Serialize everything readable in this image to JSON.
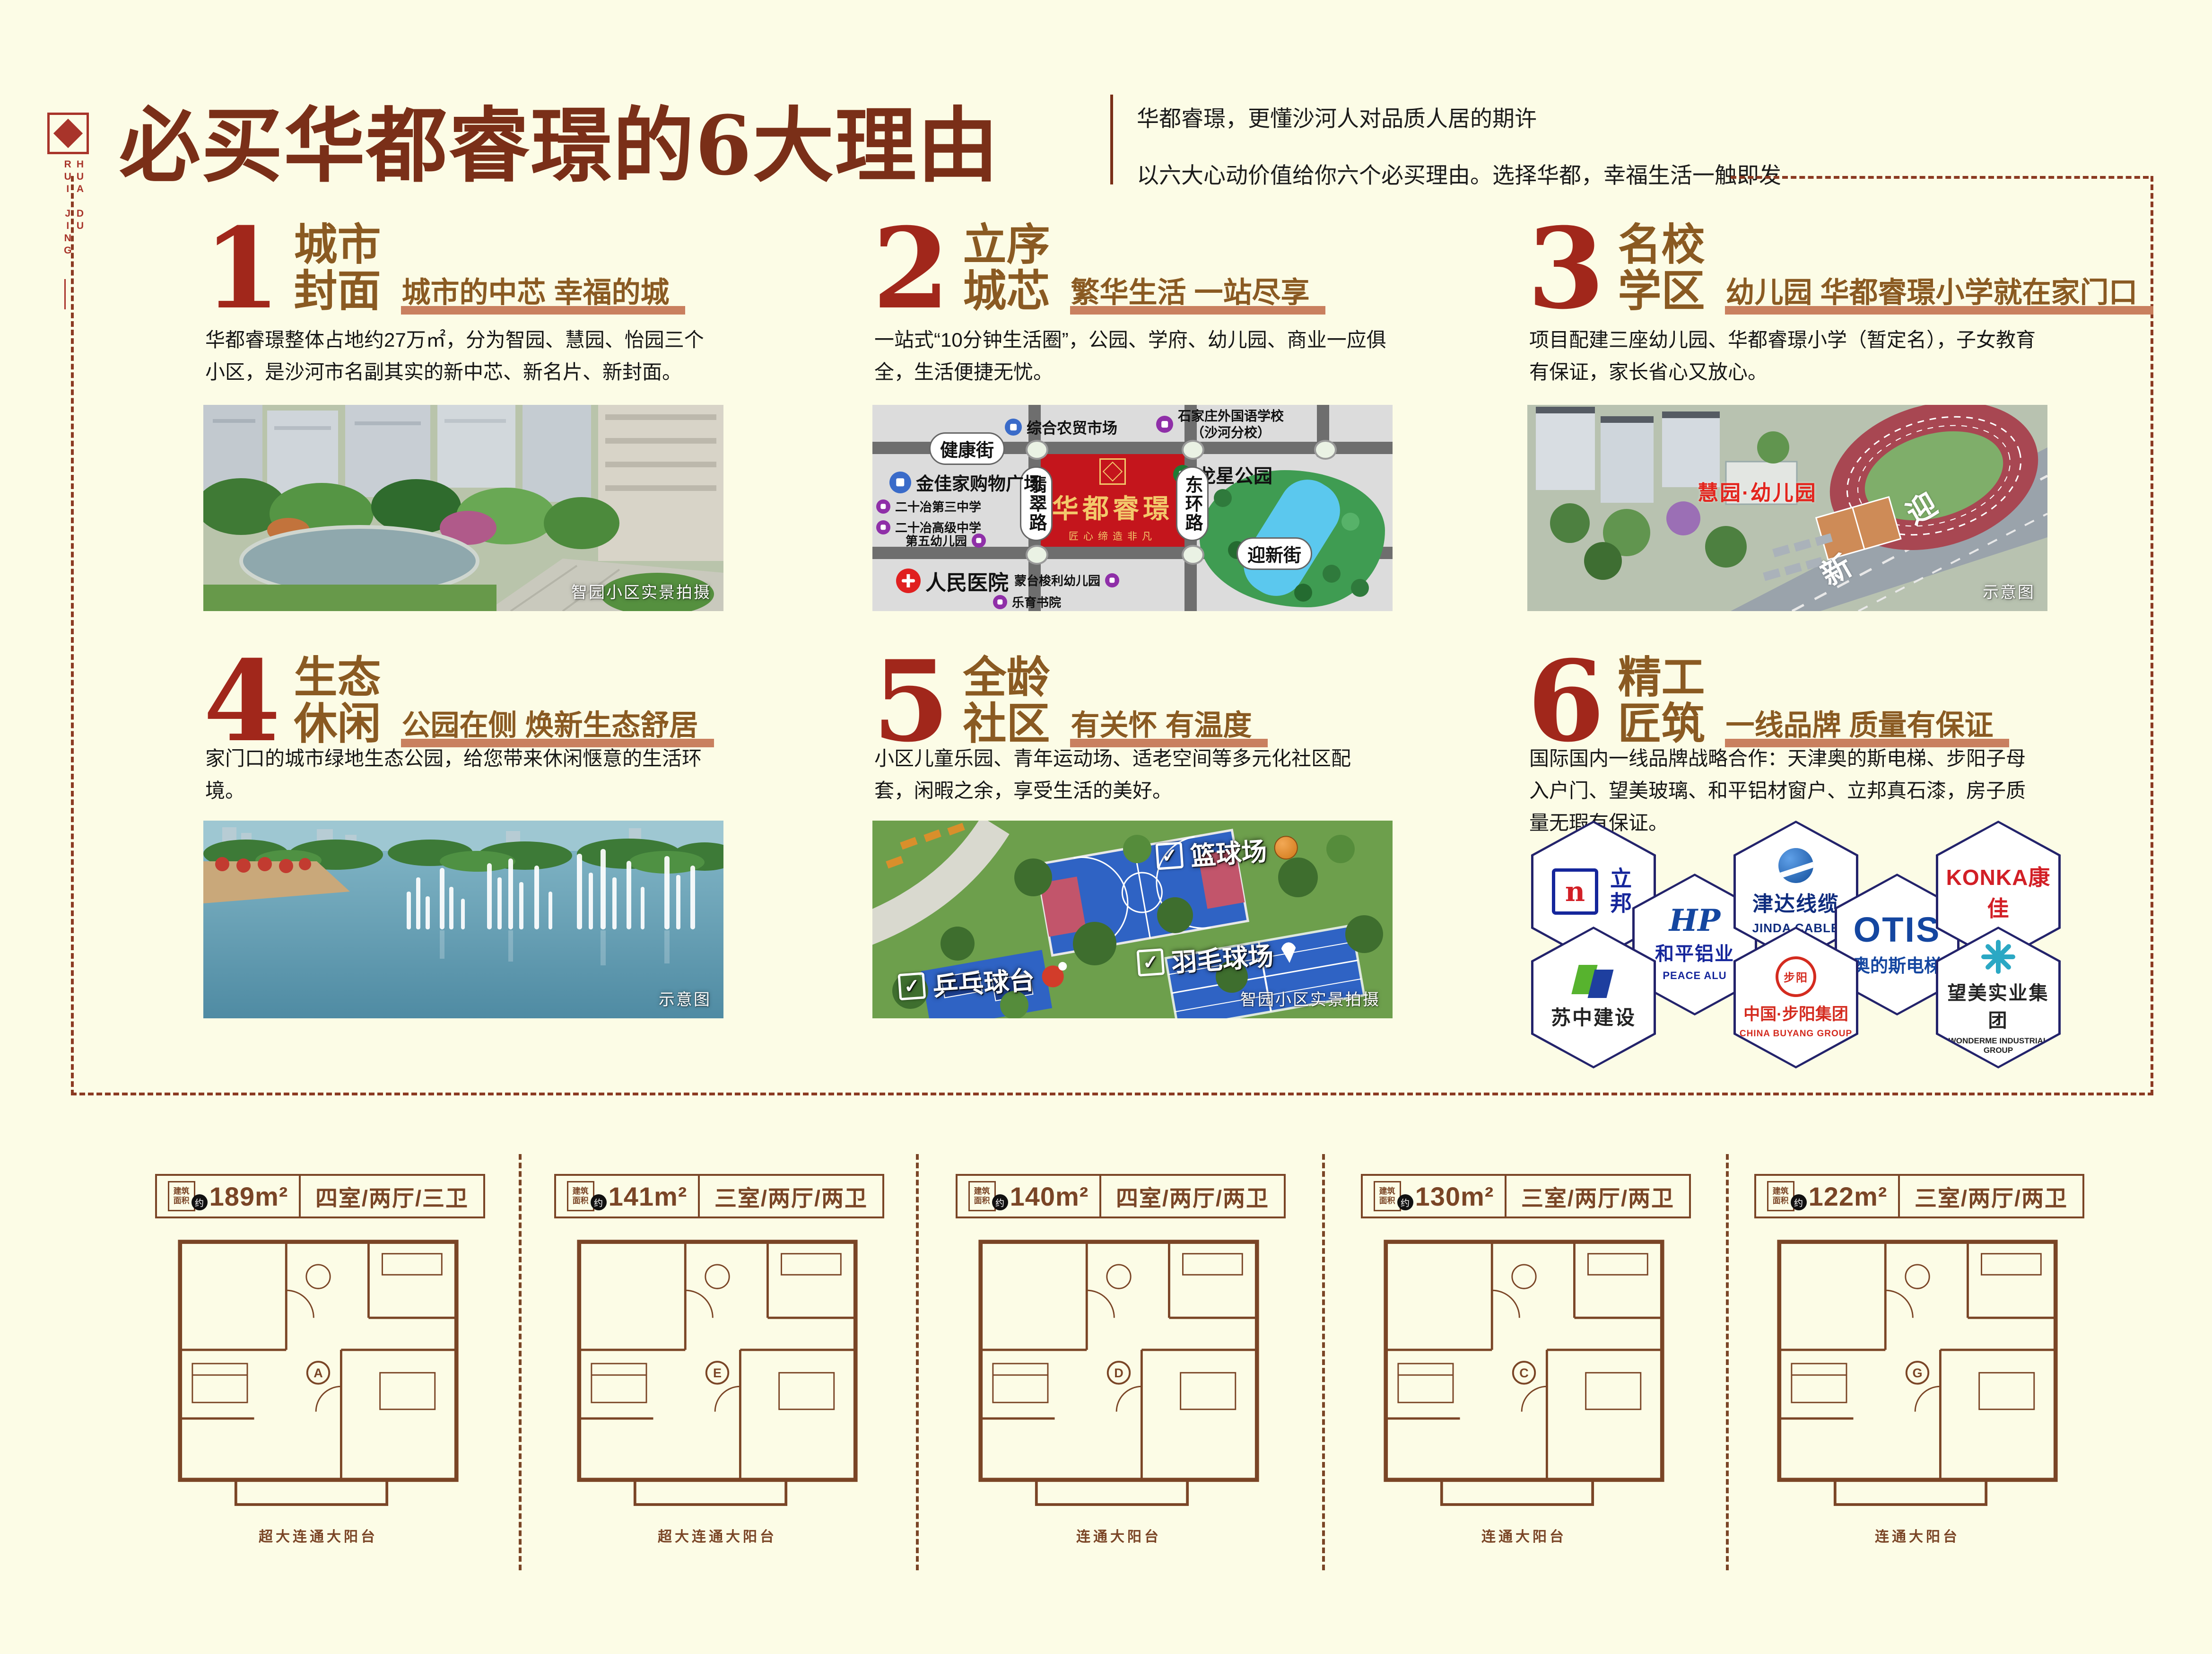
{
  "colors": {
    "background": "#FCFCE6",
    "title_red_brown": "#7A2F18",
    "number_red": "#A1271B",
    "section_brown": "#8A5A22",
    "underline_salmon": "#C9805F",
    "dash_brown": "#8B3A22",
    "floorplan_brown": "#7A4526",
    "map_project_red": "#C4151C",
    "map_park_green": "#3F9C52",
    "court_blue": "#2F63C4"
  },
  "header": {
    "logo_text": "HUA DU RUI JING",
    "title": "必买华都睿璟的6大理由",
    "subtitle1": "华都睿璟，更懂沙河人对品质人居的期许",
    "subtitle2": "以六大心动价值给你六个必买理由。选择华都，幸福生活一触即发"
  },
  "sections": [
    {
      "num": "1",
      "title_line1": "城市",
      "title_line2": "封面",
      "tagline": "城市的中芯 幸福的城",
      "body": "华都睿璟整体占地约27万㎡，分为智园、慧园、怡园三个小区，是沙河市名副其实的新中芯、新名片、新封面。"
    },
    {
      "num": "2",
      "title_line1": "立序",
      "title_line2": "城芯",
      "tagline": "繁华生活 一站尽享",
      "body": "一站式“10分钟生活圈”，公园、学府、幼儿园、商业一应俱全，生活便捷无忧。"
    },
    {
      "num": "3",
      "title_line1": "名校",
      "title_line2": "学区",
      "tagline": "幼儿园 华都睿璟小学就在家门口",
      "body": "项目配建三座幼儿园、华都睿璟小学（暂定名），子女教育有保证，家长省心又放心。"
    },
    {
      "num": "4",
      "title_line1": "生态",
      "title_line2": "休闲",
      "tagline": "公园在侧 焕新生态舒居",
      "body": "家门口的城市绿地生态公园，给您带来休闲惬意的生活环境。"
    },
    {
      "num": "5",
      "title_line1": "全龄",
      "title_line2": "社区",
      "tagline": "有关怀 有温度",
      "body": "小区儿童乐园、青年运动场、适老空间等多元化社区配套，闲暇之余，享受生活的美好。"
    },
    {
      "num": "6",
      "title_line1": "精工",
      "title_line2": "匠筑",
      "tagline": "一线品牌 质量有保证",
      "body": "国际国内一线品牌战略合作：天津奥的斯电梯、步阳子母入户门、望美玻璃、和平铝材窗户、立邦真石漆，房子质量无瑕有保证。"
    }
  ],
  "photo1": {
    "caption": "智园小区实景拍摄"
  },
  "map": {
    "street_top": "健康街",
    "street_bottom": "迎新街",
    "road_left": "翡翠路",
    "road_right": "东环路",
    "project_name": "华都睿璟",
    "project_slogan": "匠心缔造非凡",
    "park_label": "龙星公园",
    "poi_market": "综合农贸市场",
    "poi_school_fl1": "石家庄外国语学校",
    "poi_school_fl2": "（沙河分校）",
    "poi_mall": "金佳家购物广场",
    "poi_school3": "二十冶第三中学",
    "poi_school_high": "二十冶高级中学",
    "poi_kg5": "第五幼儿园",
    "poi_hospital": "人民医院",
    "poi_kg_mont": "蒙台梭利幼儿园",
    "poi_academy": "乐育书院"
  },
  "photo3": {
    "overlay_label": "慧园·幼儿园",
    "road_char1": "迎",
    "road_char2": "新",
    "caption": "示意图"
  },
  "photo4": {
    "caption": "示意图"
  },
  "photo5": {
    "check": "✓",
    "label_basketball": "篮球场",
    "label_badminton": "羽毛球场",
    "label_pingpong": "乒乓球台",
    "caption": "智园小区实景拍摄"
  },
  "brands": [
    {
      "name": "立邦",
      "glyph": "n"
    },
    {
      "name": "和平铝业",
      "sub": "PEACE ALU",
      "glyph": "HP"
    },
    {
      "name": "津达线缆",
      "sub": "JINDA CABLE"
    },
    {
      "name": "OTIS",
      "sub": "奥的斯电梯"
    },
    {
      "name": "KONKA康佳"
    },
    {
      "name": "苏中建设"
    },
    {
      "name": "中国·步阳集团",
      "sub": "CHINA BUYANG GROUP",
      "glyph": "步阳"
    },
    {
      "name": "望美实业集团",
      "sub": "WONDERME INDUSTRIAL GROUP"
    }
  ],
  "floorplans": {
    "badge_line1": "建筑",
    "badge_line2": "面积",
    "badge_approx": "约",
    "units": [
      {
        "area": "189m²",
        "rooms": "四室/两厅/三卫",
        "letter": "A",
        "balcony": "超大连通大阳台"
      },
      {
        "area": "141m²",
        "rooms": "三室/两厅/两卫",
        "letter": "E",
        "balcony": "超大连通大阳台"
      },
      {
        "area": "140m²",
        "rooms": "四室/两厅/两卫",
        "letter": "D",
        "balcony": "连通大阳台"
      },
      {
        "area": "130m²",
        "rooms": "三室/两厅/两卫",
        "letter": "C",
        "balcony": "连通大阳台"
      },
      {
        "area": "122m²",
        "rooms": "三室/两厅/两卫",
        "letter": "G",
        "balcony": "连通大阳台"
      }
    ]
  }
}
